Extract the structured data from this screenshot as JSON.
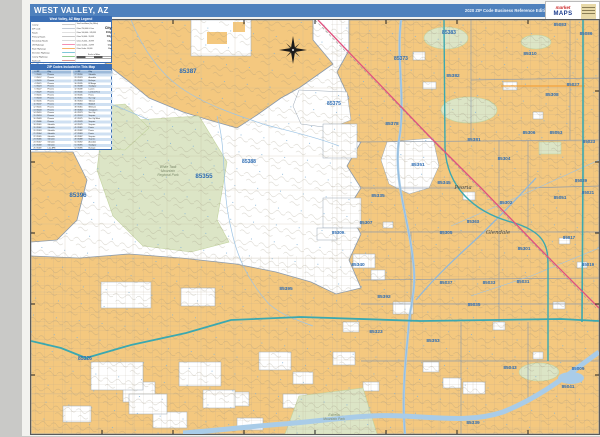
{
  "header": {
    "title": "WEST VALLEY, AZ",
    "edition": "2020 ZIP Code Business Reference Edition",
    "bg_color": "#4f81bd"
  },
  "logo": {
    "script": "market",
    "word": "MAPS"
  },
  "legend": {
    "title": "West Valley, AZ Map Legend",
    "left_items": [
      {
        "label": "County",
        "color": "#999999",
        "h": 1
      },
      {
        "label": "ZIP Code",
        "color": "#8b9aac",
        "h": 1
      },
      {
        "label": "Roads",
        "color": "#c2c2c2",
        "h": 1
      },
      {
        "label": "Primary Roads",
        "color": "#8c8c8c",
        "h": 1
      },
      {
        "label": "Secondary Roads",
        "color": "#b3b3b3",
        "h": 1
      },
      {
        "label": "US Highways",
        "color": "#f48fb1",
        "h": 2
      },
      {
        "label": "State Highways",
        "color": "#f7b267",
        "h": 2
      },
      {
        "label": "Interstate Highways",
        "color": "#7ec8d8",
        "h": 2
      },
      {
        "label": "County Highways",
        "color": "#8fce8f",
        "h": 2
      },
      {
        "label": "Railroads",
        "color": "#c0392b",
        "h": 1
      }
    ],
    "right_items": [
      {
        "label": "Total Land Area (Sq. Miles)",
        "sample": "",
        "size": 3.6
      },
      {
        "label": "Cities 250,000 & Over",
        "sample": "City",
        "size": 7
      },
      {
        "label": "Cities 100,000 - 249,999",
        "sample": "City",
        "size": 6
      },
      {
        "label": "Cities 50,000 - 99,999",
        "sample": "City",
        "size": 5
      },
      {
        "label": "Cities 25,000 - 49,999",
        "sample": "City",
        "size": 4.4
      },
      {
        "label": "Cities 10,000 - 24,999",
        "sample": "City",
        "size": 4
      },
      {
        "label": "Cities Under 10,000",
        "sample": "City",
        "size": 3.6
      }
    ],
    "scale_label": "Scale in Miles"
  },
  "zip_table": {
    "title": "ZIP Codes Included in This Map",
    "columns": [
      "#",
      "ZIP",
      "City"
    ],
    "rows": [
      [
        "1",
        "85009",
        "Phoenix"
      ],
      [
        "2",
        "85017",
        "Phoenix"
      ],
      [
        "3",
        "85019",
        "Phoenix"
      ],
      [
        "4",
        "85021",
        "Phoenix"
      ],
      [
        "5",
        "85023",
        "Phoenix"
      ],
      [
        "6",
        "85027",
        "Phoenix"
      ],
      [
        "7",
        "85029",
        "Phoenix"
      ],
      [
        "8",
        "85031",
        "Phoenix"
      ],
      [
        "9",
        "85033",
        "Phoenix"
      ],
      [
        "10",
        "85035",
        "Phoenix"
      ],
      [
        "11",
        "85037",
        "Phoenix"
      ],
      [
        "12",
        "85041",
        "Phoenix"
      ],
      [
        "13",
        "85043",
        "Phoenix"
      ],
      [
        "14",
        "85051",
        "Phoenix"
      ],
      [
        "15",
        "85053",
        "Phoenix"
      ],
      [
        "16",
        "85083",
        "Phoenix"
      ],
      [
        "17",
        "85086",
        "Phoenix"
      ],
      [
        "18",
        "85301",
        "Glendale"
      ],
      [
        "19",
        "85302",
        "Glendale"
      ],
      [
        "20",
        "85303",
        "Glendale"
      ],
      [
        "21",
        "85304",
        "Glendale"
      ],
      [
        "22",
        "85305",
        "Glendale"
      ],
      [
        "23",
        "85306",
        "Glendale"
      ],
      [
        "24",
        "85307",
        "Glendale"
      ],
      [
        "25",
        "85308",
        "Glendale"
      ],
      [
        "26",
        "85309",
        "Luke AFB"
      ],
      [
        "27",
        "85310",
        "Glendale"
      ],
      [
        "28",
        "85323",
        "Avondale"
      ],
      [
        "29",
        "85326",
        "Buckeye"
      ],
      [
        "30",
        "85335",
        "El Mirage"
      ],
      [
        "31",
        "85338",
        "Goodyear"
      ],
      [
        "32",
        "85339",
        "Laveen"
      ],
      [
        "33",
        "85340",
        "Litchfield Park"
      ],
      [
        "34",
        "85345",
        "Peoria"
      ],
      [
        "35",
        "85351",
        "Sun City"
      ],
      [
        "36",
        "85353",
        "Tolleson"
      ],
      [
        "37",
        "85355",
        "Waddell"
      ],
      [
        "38",
        "85361",
        "Wittmann"
      ],
      [
        "39",
        "85363",
        "Youngtown"
      ],
      [
        "40",
        "85373",
        "Sun City"
      ],
      [
        "41",
        "85374",
        "Surprise"
      ],
      [
        "42",
        "85375",
        "Sun City West"
      ],
      [
        "43",
        "85378",
        "Surprise"
      ],
      [
        "44",
        "85379",
        "Surprise"
      ],
      [
        "45",
        "85381",
        "Peoria"
      ],
      [
        "46",
        "85382",
        "Peoria"
      ],
      [
        "47",
        "85383",
        "Peoria"
      ],
      [
        "48",
        "85387",
        "Surprise"
      ],
      [
        "49",
        "85388",
        "Surprise"
      ],
      [
        "50",
        "85392",
        "Avondale"
      ],
      [
        "51",
        "85395",
        "Goodyear"
      ],
      [
        "52",
        "85396",
        "Buckeye"
      ]
    ]
  },
  "map": {
    "colors": {
      "zip_fill": "#f4c87f",
      "park_fill": "#dce5c6",
      "water": "#a9cce8",
      "river_line": "#8fb8dc",
      "boundary": "#8b9aac",
      "interstate": "#3ba8b0",
      "us_highway": "#e0517e",
      "state_highway": "#f2a23c",
      "zip_label": "#2e6db4",
      "grid": "#bdb298"
    },
    "grid_step": 34,
    "tick_interval": 71,
    "zip_labels": [
      {
        "t": "85387",
        "x": 157,
        "y": 53,
        "s": 6.2
      },
      {
        "t": "85396",
        "x": 47,
        "y": 177,
        "s": 6.2
      },
      {
        "t": "85355",
        "x": 173,
        "y": 158,
        "s": 6.2
      },
      {
        "t": "85388",
        "x": 218,
        "y": 143,
        "s": 5
      },
      {
        "t": "85375",
        "x": 303,
        "y": 85,
        "s": 5
      },
      {
        "t": "85378",
        "x": 361,
        "y": 105,
        "s": 4.8
      },
      {
        "t": "85373",
        "x": 370,
        "y": 40,
        "s": 5
      },
      {
        "t": "85383",
        "x": 418,
        "y": 14,
        "s": 5
      },
      {
        "t": "85083",
        "x": 529,
        "y": 6,
        "s": 4.6
      },
      {
        "t": "85086",
        "x": 555,
        "y": 15,
        "s": 4.6
      },
      {
        "t": "85310",
        "x": 499,
        "y": 35,
        "s": 4.8
      },
      {
        "t": "85027",
        "x": 542,
        "y": 66,
        "s": 4.6
      },
      {
        "t": "85308",
        "x": 521,
        "y": 76,
        "s": 4.8
      },
      {
        "t": "85382",
        "x": 422,
        "y": 57,
        "s": 4.8
      },
      {
        "t": "85381",
        "x": 443,
        "y": 121,
        "s": 4.8
      },
      {
        "t": "85306",
        "x": 498,
        "y": 114,
        "s": 4.6
      },
      {
        "t": "85053",
        "x": 525,
        "y": 114,
        "s": 4.6
      },
      {
        "t": "85023",
        "x": 558,
        "y": 123,
        "s": 4.4
      },
      {
        "t": "85304",
        "x": 473,
        "y": 140,
        "s": 4.6
      },
      {
        "t": "85029",
        "x": 550,
        "y": 162,
        "s": 4.4
      },
      {
        "t": "85351",
        "x": 387,
        "y": 146,
        "s": 4.8
      },
      {
        "t": "85345",
        "x": 413,
        "y": 164,
        "s": 4.8
      },
      {
        "t": "85335",
        "x": 347,
        "y": 177,
        "s": 4.8
      },
      {
        "t": "85363",
        "x": 442,
        "y": 203,
        "s": 4.4
      },
      {
        "t": "85305",
        "x": 415,
        "y": 214,
        "s": 4.6
      },
      {
        "t": "85302",
        "x": 475,
        "y": 184,
        "s": 4.6
      },
      {
        "t": "85051",
        "x": 529,
        "y": 179,
        "s": 4.6
      },
      {
        "t": "85021",
        "x": 557,
        "y": 174,
        "s": 4.4
      },
      {
        "t": "85301",
        "x": 493,
        "y": 230,
        "s": 4.6
      },
      {
        "t": "85017",
        "x": 538,
        "y": 219,
        "s": 4.4
      },
      {
        "t": "85019",
        "x": 557,
        "y": 246,
        "s": 4.4
      },
      {
        "t": "85340",
        "x": 327,
        "y": 246,
        "s": 4.8
      },
      {
        "t": "85307",
        "x": 335,
        "y": 204,
        "s": 4.6
      },
      {
        "t": "85309",
        "x": 307,
        "y": 214,
        "s": 4.4
      },
      {
        "t": "85392",
        "x": 353,
        "y": 278,
        "s": 4.8
      },
      {
        "t": "85037",
        "x": 415,
        "y": 264,
        "s": 4.6
      },
      {
        "t": "85033",
        "x": 458,
        "y": 264,
        "s": 4.6
      },
      {
        "t": "85031",
        "x": 492,
        "y": 263,
        "s": 4.6
      },
      {
        "t": "85035",
        "x": 443,
        "y": 286,
        "s": 4.6
      },
      {
        "t": "85323",
        "x": 345,
        "y": 313,
        "s": 4.8
      },
      {
        "t": "85353",
        "x": 402,
        "y": 322,
        "s": 4.8
      },
      {
        "t": "85395",
        "x": 255,
        "y": 270,
        "s": 4.8
      },
      {
        "t": "85326",
        "x": 54,
        "y": 340,
        "s": 5
      },
      {
        "t": "85043",
        "x": 479,
        "y": 349,
        "s": 4.8
      },
      {
        "t": "85009",
        "x": 547,
        "y": 350,
        "s": 4.6
      },
      {
        "t": "85041",
        "x": 537,
        "y": 368,
        "s": 4.6
      },
      {
        "t": "85339",
        "x": 442,
        "y": 404,
        "s": 4.8
      }
    ],
    "city_labels": [
      {
        "t": "Peoria",
        "x": 432,
        "y": 169
      },
      {
        "t": "Glendale",
        "x": 467,
        "y": 214
      }
    ],
    "park_labels": [
      {
        "lines": [
          "White Tank",
          "Mountain",
          "Regional Park"
        ],
        "x": 137,
        "y": 148
      },
      {
        "lines": [
          "Estrella",
          "Mountain Park"
        ],
        "x": 303,
        "y": 396
      }
    ]
  }
}
